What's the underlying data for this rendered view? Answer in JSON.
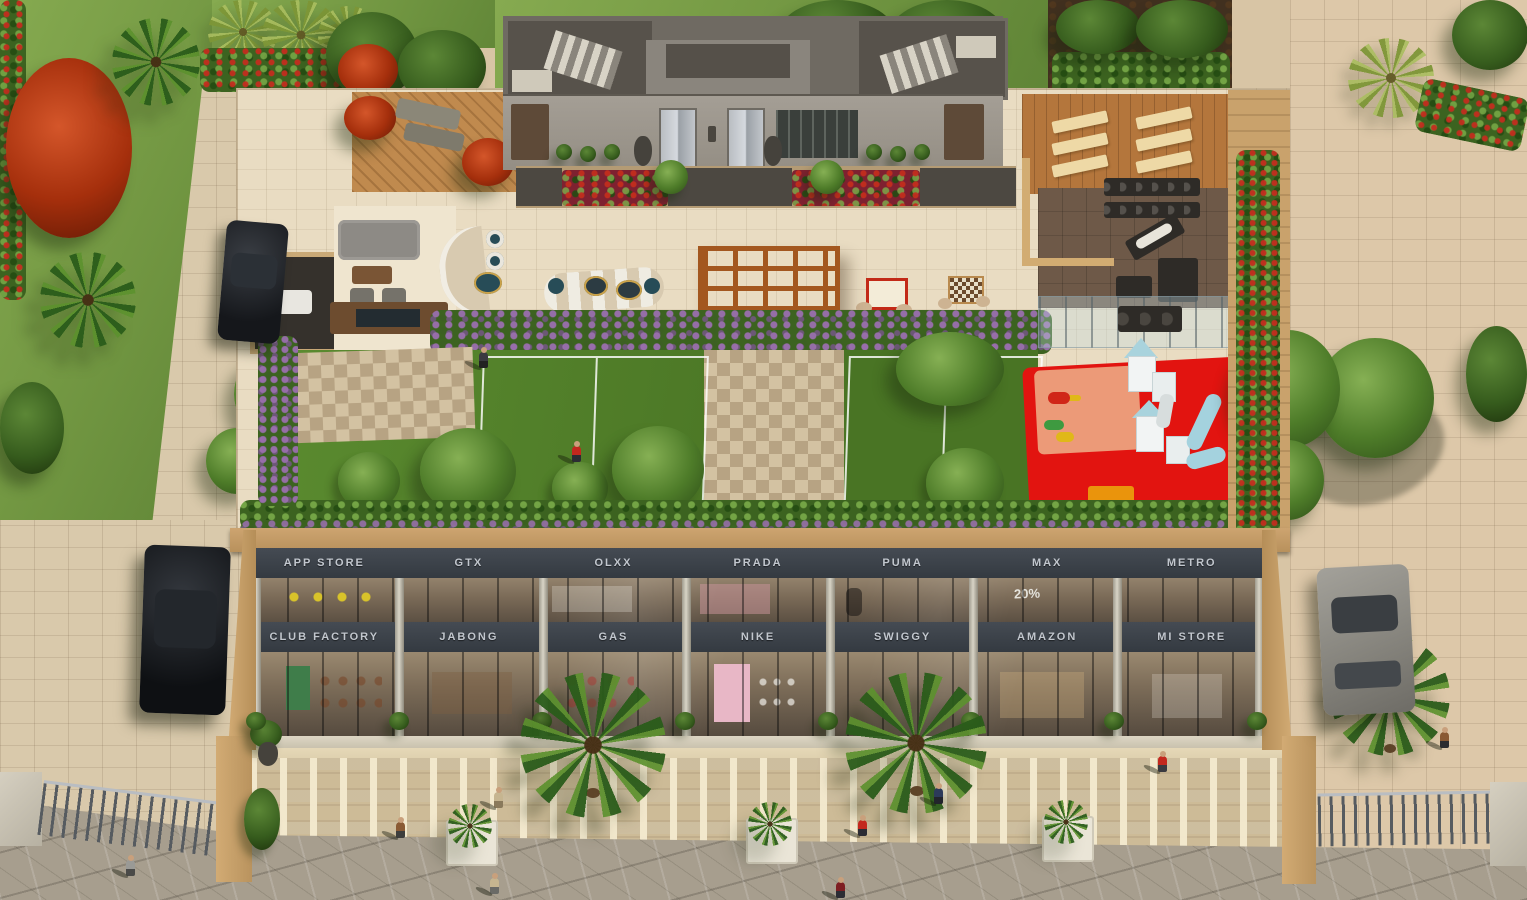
{
  "building": {
    "upper_row_stores": [
      "APP STORE",
      "GTX",
      "OLXX",
      "PRADA",
      "PUMA",
      "MAX",
      "METRO"
    ],
    "lower_row_stores": [
      "CLUB FACTORY",
      "JABONG",
      "GAS",
      "NIKE",
      "SWIGGY",
      "AMAZON",
      "MI STORE"
    ],
    "window_sign": "20%"
  },
  "colors": {
    "fascia": "#3b4149",
    "fascia_text": "#c2c7ce",
    "building_frame": "#c59a63",
    "roof_tile": "#e9dcc2",
    "rooftop_lawn": "#4f7c2b",
    "ground_lawn": "#7da24b",
    "paver": "#d8c5a5",
    "flagstone": "#a79e8e",
    "playground_red": "#e21410",
    "playground_accent": "#ea940c",
    "pergola_wood": "#a3571f",
    "purple_flowers": "#9a6fae",
    "red_flowers": "#8e2236"
  }
}
